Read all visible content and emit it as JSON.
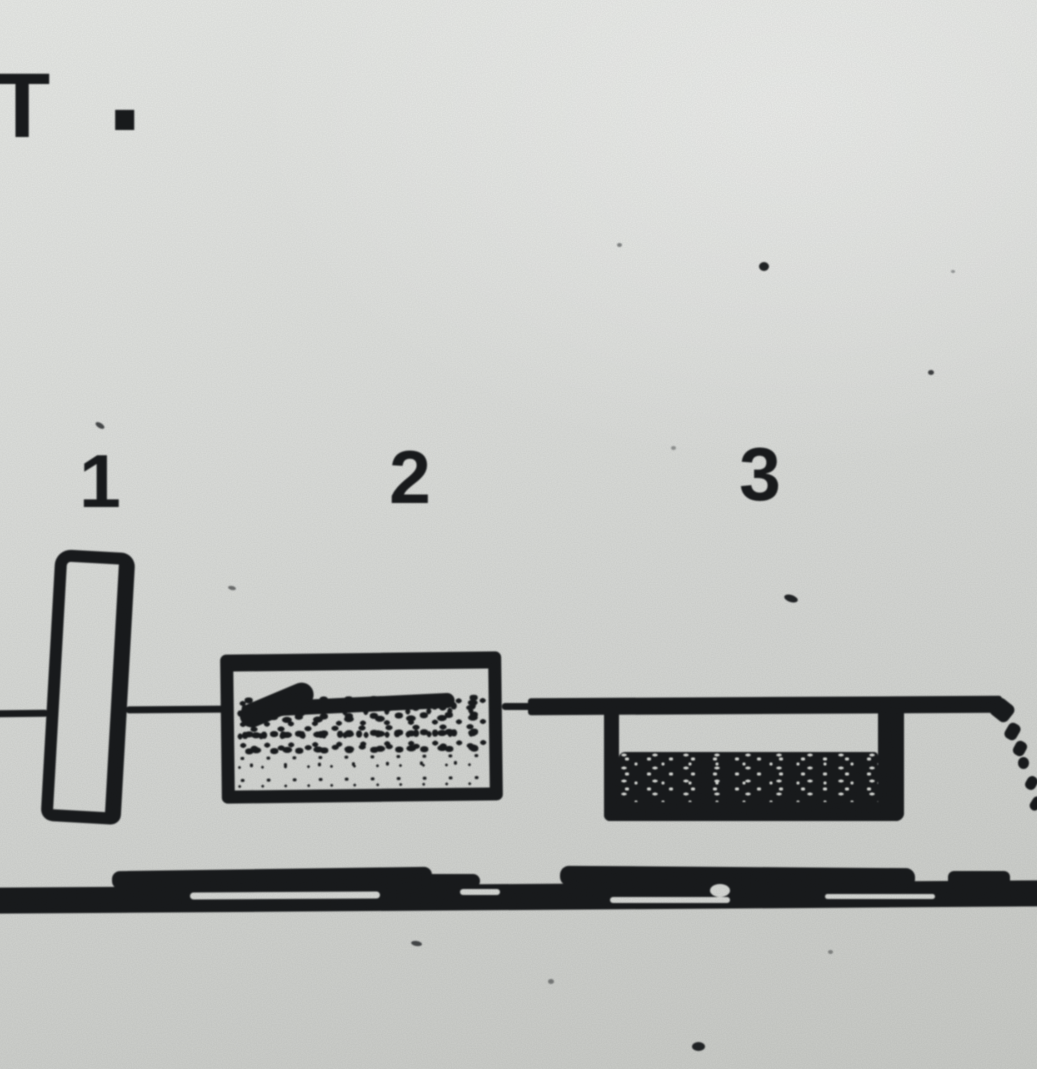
{
  "title": {
    "t": "T",
    "period": "."
  },
  "diagram": {
    "component_labels": [
      {
        "label": "1"
      },
      {
        "label": "2"
      },
      {
        "label": "3"
      }
    ]
  },
  "colors": {
    "ink": "#1d1f21",
    "paper_top": "#e6e8e5",
    "paper_bottom": "#c8cac6"
  }
}
